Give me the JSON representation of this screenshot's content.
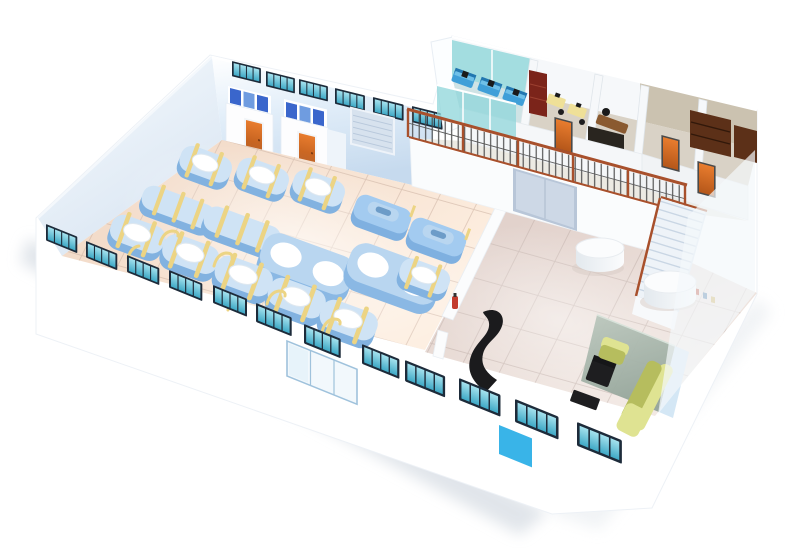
{
  "meta": {
    "title": "Factory facility — 3D isometric cutaway floor plan",
    "description": "3D isometric cutaway illustration of a factory building with a production hall full of blue machines, a mezzanine office level with railing, a staircase, and a lobby with reception desk and sofas. No text appears in the image."
  },
  "colors": {
    "bg": "#ffffff",
    "shadow": "#dce1e7",
    "wall_white": "#ffffff",
    "wall_edge": "#edf1f6",
    "window_frame": "#1d2b3a",
    "window_glass_light": "#a6e2ee",
    "window_glass_dark": "#3fa9c6",
    "floor_production_light": "#fdeee0",
    "floor_production_dark": "#f3dcca",
    "floor_grout": "#c9ae9e",
    "floor_hall_light": "#f2e9e4",
    "floor_hall_dark": "#e2d2cc",
    "hall_grout": "#bfaea8",
    "machine_blue_dark": "#82b2e0",
    "machine_top": "#cfe3f5",
    "machine_big": "#8ab8e4",
    "machine_big_top": "#b9d6f0",
    "machine_handle": "#7fb0e0",
    "machine_handle_top": "#a3cbf0",
    "machine_lid": "#ffffff",
    "strap_yellow": "#ecd484",
    "stall_partition_dark": "#3a66cc",
    "stall_partition_light": "#6f9ce0",
    "door_orange": "#e87c2e",
    "door_orange_dark": "#b5571a",
    "roller_door": "#d7e2ee",
    "roller_door_line": "#b9c9dc",
    "sliding_door": "#cdd8e6",
    "entrance_frame": "#9fc2dc",
    "blue_door": "#39b4e8",
    "divider_wall": "#fbfcfd",
    "extinguisher_red": "#c23b2e",
    "railing_rust": "#a8502c",
    "baluster_gray": "#474747",
    "mezz_glass_teal": "#8fd6da",
    "mezz_wall_tan": "#cbc2b0",
    "mezz_floor_tan": "#d9d2c6",
    "corridor_floor": "#eceae3",
    "cubicle_desk_blue": "#3f9fd8",
    "cubicle_desk_top": "#6fc0e8",
    "cubicle_desk_dark": "#2277b0",
    "bookshelf_maroon": "#7b241a",
    "bookshelf_brown": "#5c3018",
    "desk_yellow": "#efe098",
    "exec_desk_brown": "#8a5a30",
    "wardrobe_dark": "#29251f",
    "stairs_light": "#eef3f8",
    "stairs_band": "#c9d6e4",
    "cylinder_top": "#fbfcfd",
    "cylinder_side": "#e3e9ee",
    "glass_panel_light": "#bcc8be",
    "glass_panel_dark": "#93a499",
    "glass_panel_blue": "#cfe4f4",
    "sofa_yellow": "#dfe392",
    "sofa_yellow_dark": "#b6bd5e",
    "reception_black": "#1b1b1d",
    "furniture_black": "#1e1e20",
    "monitor_black": "#1a1a1a"
  },
  "scene": {
    "type": "isometric-cutaway-floorplan",
    "ground_floor": {
      "production_hall": {
        "floor": "peach tiles",
        "machines_with_round_lid": 9,
        "plain_tanks": 2,
        "double_lid_vats": 2,
        "machines_with_handle": 2,
        "yellow_straps": true,
        "toilet_stalls": 2,
        "stall_doors": "orange",
        "roller_shutter_door": 1,
        "back_wall_window_strips": 6
      },
      "hall": {
        "round_white_tables": 2,
        "sliding_door": 1,
        "staircase": 1
      },
      "lobby": {
        "reception_desk": "curved black",
        "black_chair": 1,
        "black_coffee_tables": 2,
        "sofa_set": "yellow-green, armchair + long sofa",
        "glass_partition": "gray-green panel"
      },
      "front_wall_window_strips": 12,
      "glass_entrance_panels": 3,
      "blue_service_door": 1
    },
    "mezzanine": {
      "railing": "ornamental wrought iron with rust top rail",
      "rooms": [
        {
          "name": "open-plan office",
          "glass": "teal",
          "blue_workstations": 3
        },
        {
          "name": "office with yellow desks",
          "bookshelf": "maroon",
          "yellow_desks": 2
        },
        {
          "name": "manager office",
          "desk": "wooden",
          "wardrobe": "dark"
        },
        {
          "name": "library room",
          "bookshelves": 2
        }
      ],
      "orange_doors": 3
    }
  }
}
